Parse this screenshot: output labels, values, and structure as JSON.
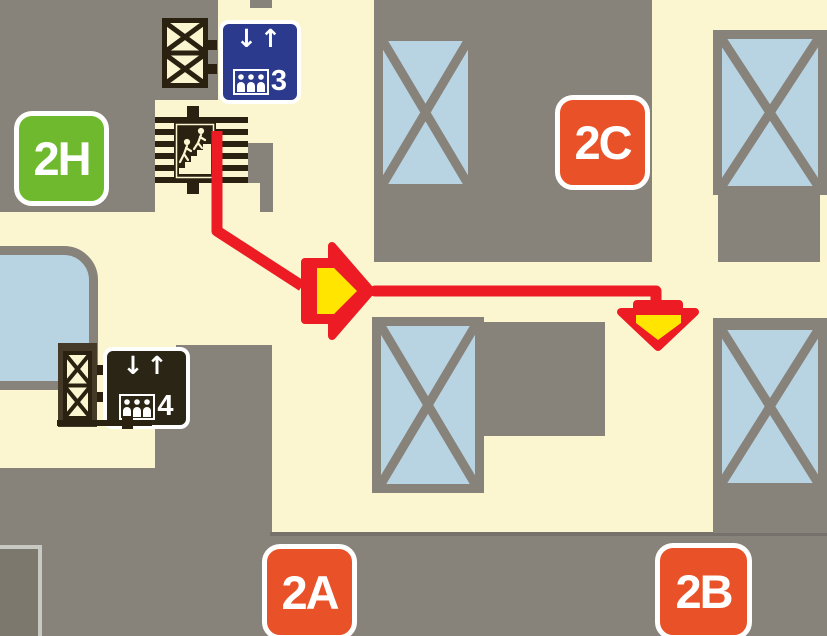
{
  "map_title": "station-floor-exit-map",
  "exits": {
    "h": {
      "label": "2H",
      "color": "#6FB92F"
    },
    "c": {
      "label": "2C",
      "color": "#E95228"
    },
    "a": {
      "label": "2A",
      "color": "#E95228"
    },
    "b": {
      "label": "2B",
      "color": "#E95228"
    }
  },
  "elevator_signs": {
    "upper": {
      "number": "3",
      "background": "#2B3A8D"
    },
    "lower": {
      "number": "4",
      "background": "#2B2516"
    },
    "down_arrow": "↓",
    "up_arrow": "↑"
  },
  "route": {
    "from": "stairs",
    "waypoints": "down, diagonal to corridor, right, down",
    "color": "#EC1B24",
    "marker_fill": "#FFE500"
  },
  "colors": {
    "floor": "#FBF6D0",
    "wall": "#87827A",
    "closed_area": "#B8D3E2",
    "icon_black": "#2A2110",
    "sign_white": "#FFFFFF"
  }
}
